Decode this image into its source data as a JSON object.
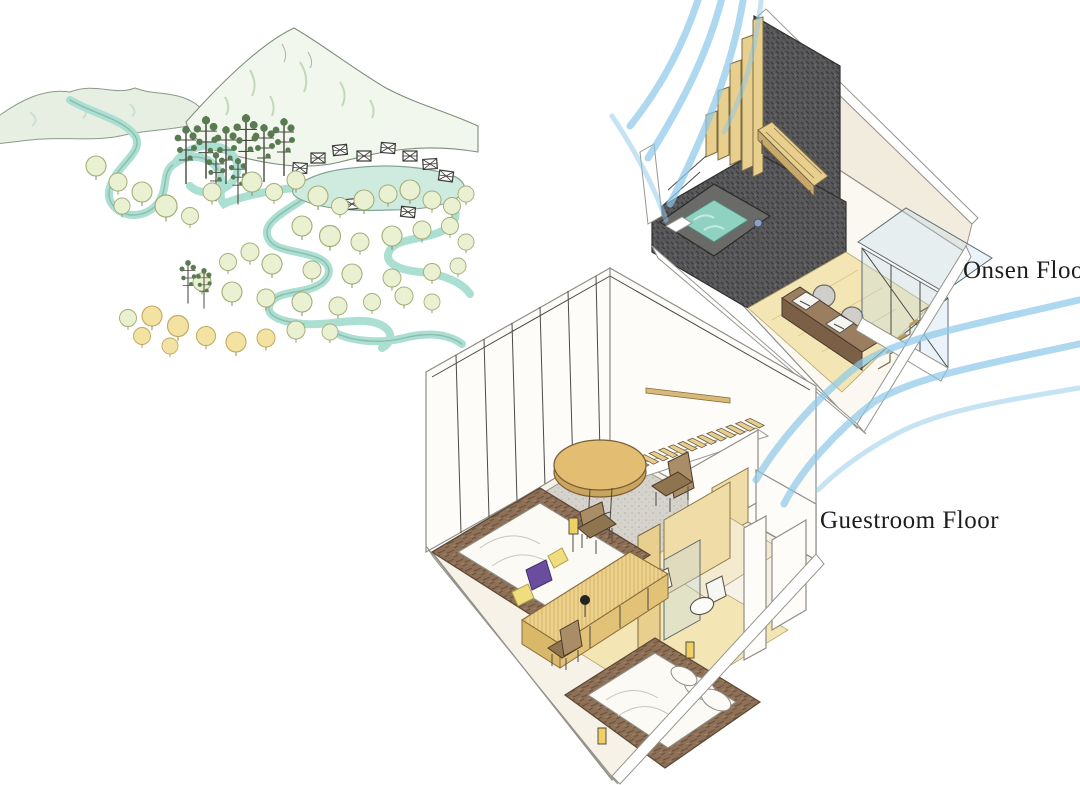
{
  "page": {
    "width": 1080,
    "height": 785,
    "background": "#ffffff",
    "description": "Hand-drawn concept sketch of a mountain onsen resort: landscape vignette plus two isometric cutaway floor plans"
  },
  "labels": {
    "onsen_floor": "Onsen Floor",
    "guestroom_floor": "Guestroom Floor"
  },
  "palette": {
    "breeze_blue": "#8cc8e8",
    "water_teal": "#8fd2c2",
    "river_teal": "#aadfd2",
    "pond_teal": "#cfeadf",
    "charcoal_wall": "#555553",
    "wood_tan": "#e9cf8e",
    "counter_brown": "#9b7d5f",
    "platform_brown": "#8a6e52",
    "carpet_gray": "#d6d2cc",
    "cream_wall": "#f2ecdf",
    "tree_green": "#eaf0d2",
    "pine_green": "#5a7a52",
    "autumn_yellow": "#f3e3a2",
    "accent_purple": "#6a4d9e"
  },
  "scene": {
    "landscape": {
      "features": [
        "mountain range",
        "winding river",
        "pine grove",
        "broadleaf forest",
        "autumn trees",
        "resort pond",
        "village cabins"
      ]
    },
    "onsen_floor": {
      "elements": [
        "open-air bath",
        "charcoal stone feature wall",
        "timber slat screen",
        "timber bench",
        "shower fixture",
        "twin vanity basins",
        "round mirrors",
        "glazed stair enclosure",
        "breeze flow lines"
      ]
    },
    "guestroom_floor": {
      "elements": [
        "glazed wall with mullions",
        "carpeted lounge",
        "round timber table",
        "two chairs",
        "timber staircase",
        "bed with purple and yellow cushions",
        "timber joinery console",
        "reading lamp",
        "bathroom with wc and basin",
        "second bed",
        "timber partitions"
      ]
    }
  }
}
